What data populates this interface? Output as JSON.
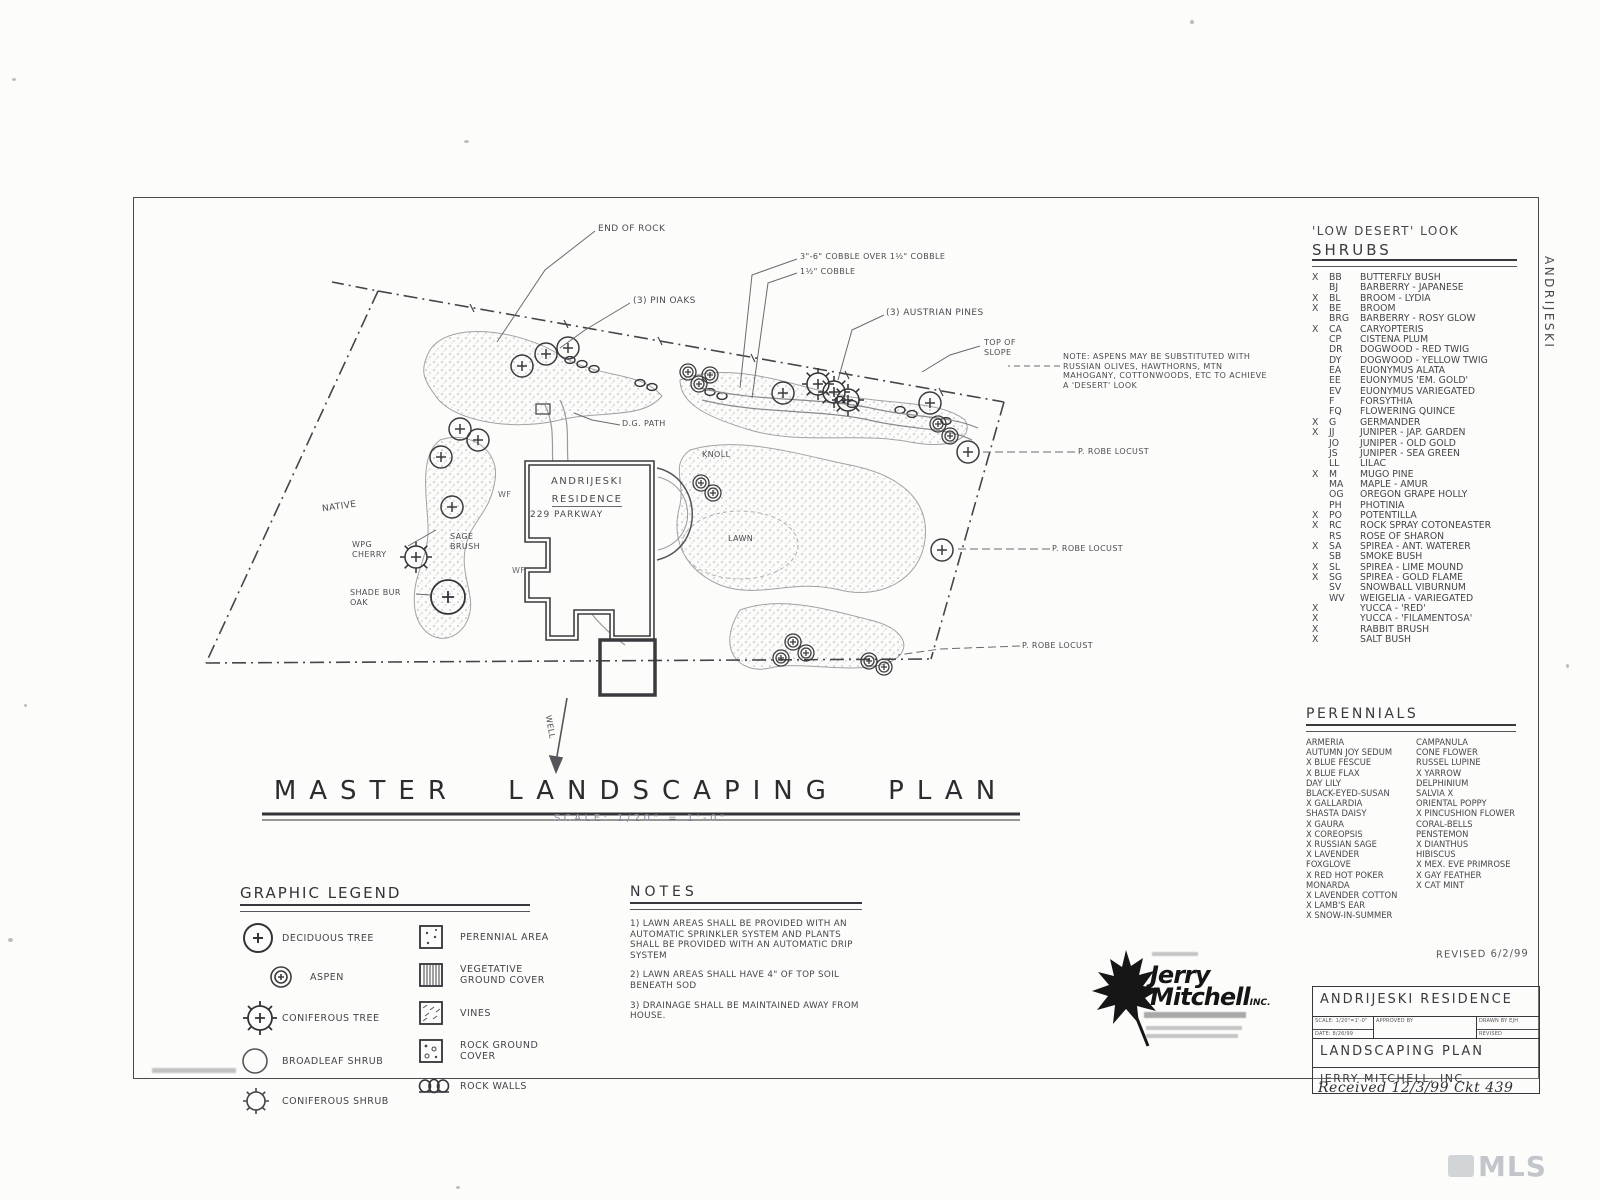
{
  "sheet": {
    "side_label": "ANDRIJESKI",
    "watermark": "MLS",
    "received_note": "Received 12/3/99 Ckt 439",
    "revised_note": "REVISED 6/2/99"
  },
  "plan": {
    "title": "MASTER LANDSCAPING PLAN",
    "scale_text": "SCALE: 1/20\" = 1'-0\"",
    "house": {
      "name_line1": "ANDRIJESKI",
      "name_line2": "RESIDENCE",
      "address": "229 PARKWAY"
    },
    "labels": {
      "end_of_rock": "END OF ROCK",
      "pin_oaks": "(3) PIN OAKS",
      "cobble_over": "3\"-6\" COBBLE OVER 1½\" COBBLE",
      "cobble": "1½\" COBBLE",
      "austrian_pines": "(3) AUSTRIAN PINES",
      "top_of_slope": "TOP OF SLOPE",
      "aspen_note": "NOTE: ASPENS MAY BE SUBSTITUTED WITH RUSSIAN OLIVES, HAWTHORNS, MTN MAHOGANY, COTTONWOODS, ETC TO ACHIEVE A 'DESERT' LOOK",
      "robe_locust_1": "P. ROBE LOCUST",
      "robe_locust_2": "P. ROBE LOCUST",
      "robe_locust_3": "P. ROBE LOCUST",
      "native": "NATIVE",
      "wpg_cherry": "WPG CHERRY",
      "sage_brush": "SAGE BRUSH",
      "shade_bur_oak": "SHADE BUR OAK",
      "dg_path": "D.G. PATH",
      "knoll": "KNOLL",
      "lawn": "LAWN",
      "well": "WELL",
      "plant_code_wf_1": "WF",
      "plant_code_wf_2": "WF"
    }
  },
  "shrub_list": {
    "header_line1": "'LOW DESERT' LOOK",
    "header_line2": "SHRUBS",
    "items": [
      {
        "x": "X",
        "code": "BB",
        "name": "BUTTERFLY BUSH"
      },
      {
        "x": "",
        "code": "BJ",
        "name": "BARBERRY - JAPANESE"
      },
      {
        "x": "X",
        "code": "BL",
        "name": "BROOM - LYDIA"
      },
      {
        "x": "X",
        "code": "BE",
        "name": "BROOM"
      },
      {
        "x": "",
        "code": "BRG",
        "name": "BARBERRY - ROSY GLOW"
      },
      {
        "x": "X",
        "code": "CA",
        "name": "CARYOPTERIS"
      },
      {
        "x": "",
        "code": "CP",
        "name": "CISTENA PLUM"
      },
      {
        "x": "",
        "code": "DR",
        "name": "DOGWOOD - RED TWIG"
      },
      {
        "x": "",
        "code": "DY",
        "name": "DOGWOOD - YELLOW TWIG"
      },
      {
        "x": "",
        "code": "EA",
        "name": "EUONYMUS ALATA"
      },
      {
        "x": "",
        "code": "EE",
        "name": "EUONYMUS 'EM. GOLD'"
      },
      {
        "x": "",
        "code": "EV",
        "name": "EUONYMUS VARIEGATED"
      },
      {
        "x": "",
        "code": "F",
        "name": "FORSYTHIA"
      },
      {
        "x": "",
        "code": "FQ",
        "name": "FLOWERING QUINCE"
      },
      {
        "x": "X",
        "code": "G",
        "name": "GERMANDER"
      },
      {
        "x": "X",
        "code": "JJ",
        "name": "JUNIPER - JAP. GARDEN"
      },
      {
        "x": "",
        "code": "JO",
        "name": "JUNIPER - OLD GOLD"
      },
      {
        "x": "",
        "code": "JS",
        "name": "JUNIPER - SEA GREEN"
      },
      {
        "x": "",
        "code": "LL",
        "name": "LILAC"
      },
      {
        "x": "X",
        "code": "M",
        "name": "MUGO PINE"
      },
      {
        "x": "",
        "code": "MA",
        "name": "MAPLE - AMUR"
      },
      {
        "x": "",
        "code": "OG",
        "name": "OREGON GRAPE HOLLY"
      },
      {
        "x": "",
        "code": "PH",
        "name": "PHOTINIA"
      },
      {
        "x": "X",
        "code": "PO",
        "name": "POTENTILLA"
      },
      {
        "x": "X",
        "code": "RC",
        "name": "ROCK SPRAY COTONEASTER"
      },
      {
        "x": "",
        "code": "RS",
        "name": "ROSE OF SHARON"
      },
      {
        "x": "X",
        "code": "SA",
        "name": "SPIREA - ANT. WATERER"
      },
      {
        "x": "",
        "code": "SB",
        "name": "SMOKE BUSH"
      },
      {
        "x": "X",
        "code": "SL",
        "name": "SPIREA - LIME MOUND"
      },
      {
        "x": "X",
        "code": "SG",
        "name": "SPIREA - GOLD FLAME"
      },
      {
        "x": "",
        "code": "SV",
        "name": "SNOWBALL VIBURNUM"
      },
      {
        "x": "",
        "code": "WV",
        "name": "WEIGELIA - VARIEGATED"
      },
      {
        "x": "X",
        "code": "",
        "name": "YUCCA - 'RED'"
      },
      {
        "x": "X",
        "code": "",
        "name": "YUCCA - 'FILAMENTOSA'"
      },
      {
        "x": "X",
        "code": "",
        "name": "RABBIT BRUSH"
      },
      {
        "x": "X",
        "code": "",
        "name": "SALT BUSH"
      }
    ]
  },
  "perennial_list": {
    "header": "PERENNIALS",
    "rows": [
      {
        "l": "ARMERIA",
        "r": "CAMPANULA"
      },
      {
        "l": "AUTUMN JOY SEDUM",
        "r": "CONE FLOWER"
      },
      {
        "l": "X BLUE FESCUE",
        "r": "RUSSEL LUPINE"
      },
      {
        "l": "X BLUE FLAX",
        "r": "X YARROW"
      },
      {
        "l": "DAY LILY",
        "r": "DELPHINIUM"
      },
      {
        "l": "BLACK-EYED-SUSAN",
        "r": "SALVIA X"
      },
      {
        "l": "X GALLARDIA",
        "r": "ORIENTAL POPPY"
      },
      {
        "l": "SHASTA DAISY",
        "r": "X PINCUSHION FLOWER"
      },
      {
        "l": "X GAURA",
        "r": "CORAL-BELLS"
      },
      {
        "l": "X COREOPSIS",
        "r": "PENSTEMON"
      },
      {
        "l": "X RUSSIAN SAGE",
        "r": "X DIANTHUS"
      },
      {
        "l": "X LAVENDER",
        "r": "HIBISCUS"
      },
      {
        "l": "FOXGLOVE",
        "r": "X MEX. EVE PRIMROSE"
      },
      {
        "l": "X RED HOT POKER",
        "r": "X GAY FEATHER"
      },
      {
        "l": "MONARDA",
        "r": "X CAT MINT"
      },
      {
        "l": "X LAVENDER COTTON",
        "r": ""
      },
      {
        "l": "X LAMB'S EAR",
        "r": ""
      },
      {
        "l": "X SNOW-IN-SUMMER",
        "r": ""
      }
    ]
  },
  "legend": {
    "header": "GRAPHIC LEGEND",
    "left_items": [
      "DECIDUOUS TREE",
      "ASPEN",
      "CONIFEROUS TREE",
      "BROADLEAF SHRUB",
      "CONIFEROUS SHRUB"
    ],
    "right_items": [
      "PERENNIAL AREA",
      "VEGETATIVE GROUND COVER",
      "VINES",
      "ROCK GROUND COVER",
      "ROCK WALLS"
    ]
  },
  "notes": {
    "header": "NOTES",
    "items": [
      "1) LAWN AREAS SHALL BE PROVIDED WITH AN AUTOMATIC SPRINKLER SYSTEM AND PLANTS SHALL BE PROVIDED WITH AN AUTOMATIC DRIP SYSTEM",
      "2) LAWN AREAS SHALL HAVE 4\" OF TOP SOIL BENEATH SOD",
      "3) DRAINAGE SHALL BE MAINTAINED AWAY FROM HOUSE."
    ]
  },
  "firm": {
    "name1": "Jerry",
    "name2": "Mitchell",
    "suffix": "INC."
  },
  "title_block": {
    "project": "ANDRIJESKI RESIDENCE",
    "scale_label": "SCALE:",
    "scale_value": "1/20\"=1'-0\"",
    "date_label": "DATE:",
    "date_value": "8/26/99",
    "approved_label": "APPROVED BY",
    "drawn_label": "DRAWN BY",
    "drawn_value": "EJH",
    "revised_label": "REVISED",
    "sheet_title": "LANDSCAPING PLAN",
    "firm_name": "JERRY MITCHELL, INC"
  }
}
